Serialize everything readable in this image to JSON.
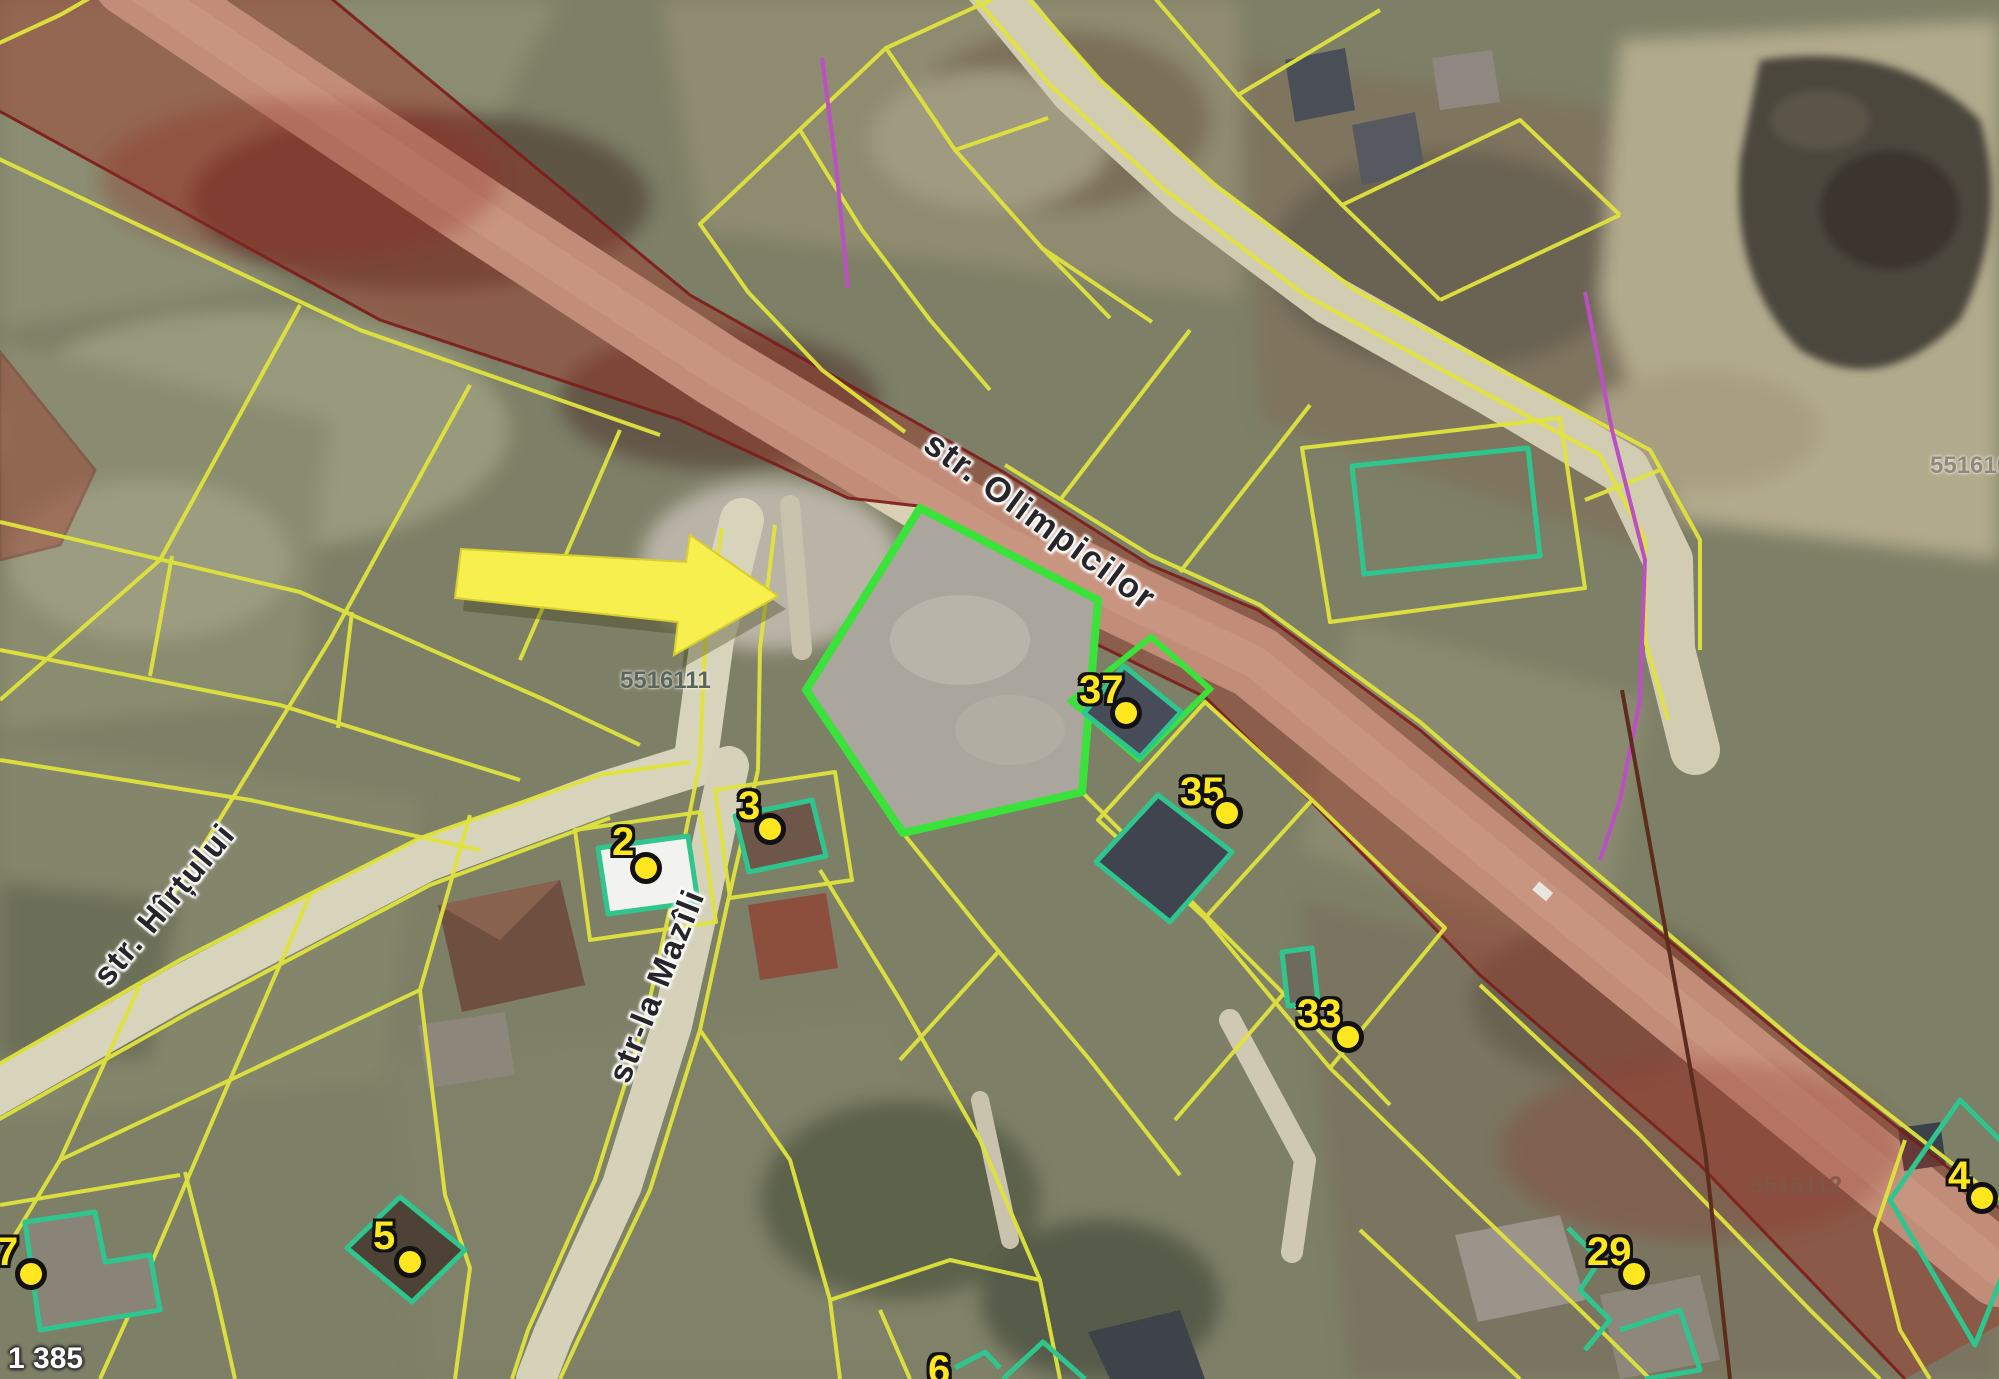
{
  "map": {
    "streets": [
      {
        "name": "str. Olimpicilor"
      },
      {
        "name": "str. Hîrțului"
      },
      {
        "name": "str-la Mazîli"
      }
    ],
    "parcel_ids": [
      {
        "id": "5516111"
      },
      {
        "id": "5516103"
      },
      {
        "id": "5516112"
      }
    ],
    "markers": [
      {
        "label": "37"
      },
      {
        "label": "35"
      },
      {
        "label": "33"
      },
      {
        "label": "29"
      },
      {
        "label": "2"
      },
      {
        "label": "3"
      },
      {
        "label": "5"
      },
      {
        "label": "7"
      },
      {
        "label": "4"
      },
      {
        "label": "6"
      }
    ],
    "corner_label": "1 385",
    "colors": {
      "parcel_line": "#e0e43c",
      "highlight_parcel": "#39e339",
      "building_outline": "#2ec68e",
      "marker": "#ffe71f",
      "restriction_overlay": "#a03227",
      "road_fill": "#dbcfb4",
      "annotation_arrow": "#f7ef4e",
      "utility_line": "#bb50c4"
    }
  }
}
